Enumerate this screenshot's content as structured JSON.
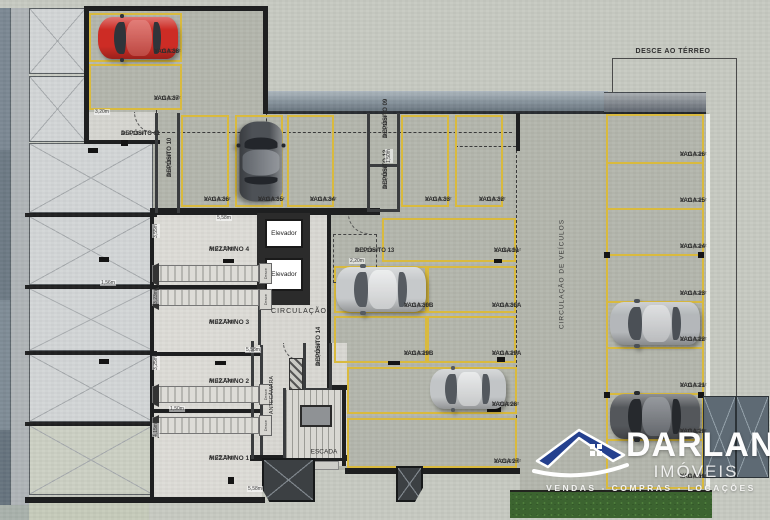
{
  "stalls": [
    {
      "name": "VAGA 38",
      "area": "A: 11,52m²"
    },
    {
      "name": "VAGA 37",
      "area": "A: 11,52m²"
    },
    {
      "name": "VAGA 36",
      "area": "A: 11,52m²"
    },
    {
      "name": "VAGA 35",
      "area": "A: 11,52m²"
    },
    {
      "name": "VAGA 34",
      "area": "A: 11,52m²"
    },
    {
      "name": "VAGA 33",
      "area": "A: 11,52m²"
    },
    {
      "name": "VAGA 32",
      "area": "A: 11,52m²"
    },
    {
      "name": "VAGA 31",
      "area": "A: 16,68m²"
    },
    {
      "name": "VAGA 30B",
      "area": "A: 11,52m²"
    },
    {
      "name": "VAGA 30A",
      "area": "A: 11,52m²"
    },
    {
      "name": "VAGA 29B",
      "area": "A: 11,52m²"
    },
    {
      "name": "VAGA 29A",
      "area": "A: 11,52m²"
    },
    {
      "name": "VAGA 28",
      "area": "A: 23,65m²"
    },
    {
      "name": "VAGA 27",
      "area": "A: 23,65m²"
    },
    {
      "name": "VAGA 26",
      "area": "A: 11,52m²"
    },
    {
      "name": "VAGA 25",
      "area": "A: 11,52m²"
    },
    {
      "name": "VAGA 24",
      "area": "A: 11,52m²"
    },
    {
      "name": "VAGA 23",
      "area": "A: 11,52m²"
    },
    {
      "name": "VAGA 22",
      "area": "A: 11,52m²"
    },
    {
      "name": "VAGA 21",
      "area": "A: 11,52m²"
    },
    {
      "name": "VAGA 20",
      "area": "A: 11,52m²"
    },
    {
      "name": "VAGA 19",
      "area": "A: 11,52m²"
    }
  ],
  "depositos": [
    {
      "name": "DEPÓSITO 11",
      "area": "A: 4,18m²"
    },
    {
      "name": "DEPÓSITO 10",
      "area": "A: 4,18m²"
    },
    {
      "name": "DEPÓSITO 09",
      "area": "A: 3,36m²"
    },
    {
      "name": "DEPÓSITO 12",
      "area": "A: 2,98m²"
    },
    {
      "name": "DEPÓSITO 13",
      "area": "A: 3,19m²"
    },
    {
      "name": "DEPÓSITO 14",
      "area": "A: 3,39m²"
    }
  ],
  "mezzanines": [
    {
      "name": "MEZANINO 4",
      "area": "A: 21,99m²"
    },
    {
      "name": "MEZANINO 3",
      "area": "A: 19,73m²"
    },
    {
      "name": "MEZANINO 2",
      "area": "A: 19,73m²"
    },
    {
      "name": "MEZANINO 1",
      "area": "A: 25,39m²"
    }
  ],
  "rooms": {
    "elevator": "Elevador",
    "circulation": "CIRCULAÇÃO",
    "stairs": "ESCADA",
    "antechamber": "ANTECÂMARA",
    "stair_direction": "Desce"
  },
  "annotations": {
    "ramp": "DESCE AO TÉRREO",
    "vehicle_lane": "CIRCULAÇÃO DE VEÍCULOS"
  },
  "dimensions": [
    "3,20m",
    "5,58m",
    "5,58m",
    "5,58m",
    "1,56m",
    "1,50m",
    "3,55m",
    "3,23m",
    "3,25m",
    "4,15m",
    "2,20m",
    "1,50m"
  ],
  "logo": {
    "brand": "DARLAN",
    "segment": "IMÓVEIS",
    "tagline": "VENDAS - COMPRAS - LOCAÇÕES"
  },
  "colors": {
    "stall_line": "#d9ba3e",
    "wall": "#1e1f20",
    "floor_garage": "#b4b7ad",
    "floor_mezzanine": "#dddcd7",
    "logo_blue": "#24408e",
    "hedge_green": "#3c6430",
    "car_red": "#cf2e27"
  }
}
